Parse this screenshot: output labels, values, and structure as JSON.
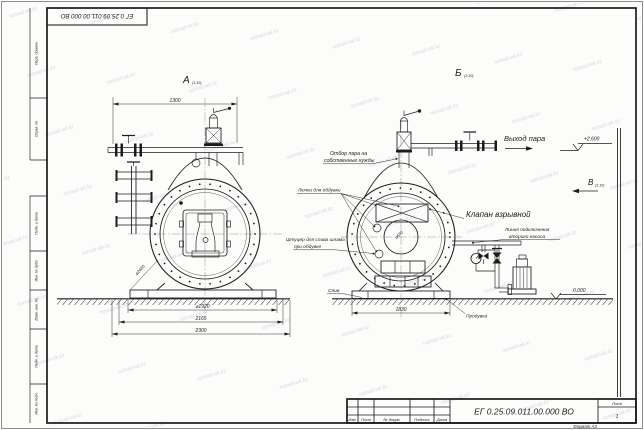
{
  "page": {
    "top_stamp": "ЕГ 0.25.09.011.00.000 ВО",
    "watermark_text": "nomad-wk.kz"
  },
  "margin_labels": [
    "Перв. примен.",
    "Справ. №",
    "Подп. и дата",
    "Инв. № дубл.",
    "Взам. инв. №",
    "Подп. и дата",
    "Инв. № подл."
  ],
  "view_a": {
    "label": "А",
    "scale": "(1:10)",
    "dim_top": "1300",
    "dim_diameter": "⌀1920",
    "dim_mid": "2165",
    "dim_base": "2300",
    "dim_diag": "⌀2420"
  },
  "view_b": {
    "label": "Б",
    "scale": "(1:10)",
    "dim_base": "1830",
    "manhole_diameter": "⌀650"
  },
  "marks": {
    "steam_out": "Выход пара",
    "level_top": "+2,600",
    "level_zero": "0,000",
    "view_v": "В",
    "view_v_scale": "(1:10)"
  },
  "annotations": {
    "explosion_valve": "Клапан взрывной",
    "second_pump_line1": "Линия подключения",
    "second_pump_line2": "второго насоса",
    "own_needs_line1": "Отбор пара на",
    "own_needs_line2": "собственные нужды",
    "blow_hatches": "Лючки для обдувки",
    "sludge_line1": "Штуцер для слива шлама",
    "sludge_line2": "при обдувке",
    "drain": "Слив",
    "blowdown": "Продувка"
  },
  "title_block": {
    "designation": "ЕГ 0.25.09.011.00.000 ВО",
    "h_izm": "Изм.",
    "h_list": "Лист",
    "h_doc": "№ докум.",
    "h_sign": "Подпись",
    "h_date": "Дата",
    "sheet_label": "Лист",
    "sheet_no": "1",
    "format_note": "Формат А3"
  }
}
